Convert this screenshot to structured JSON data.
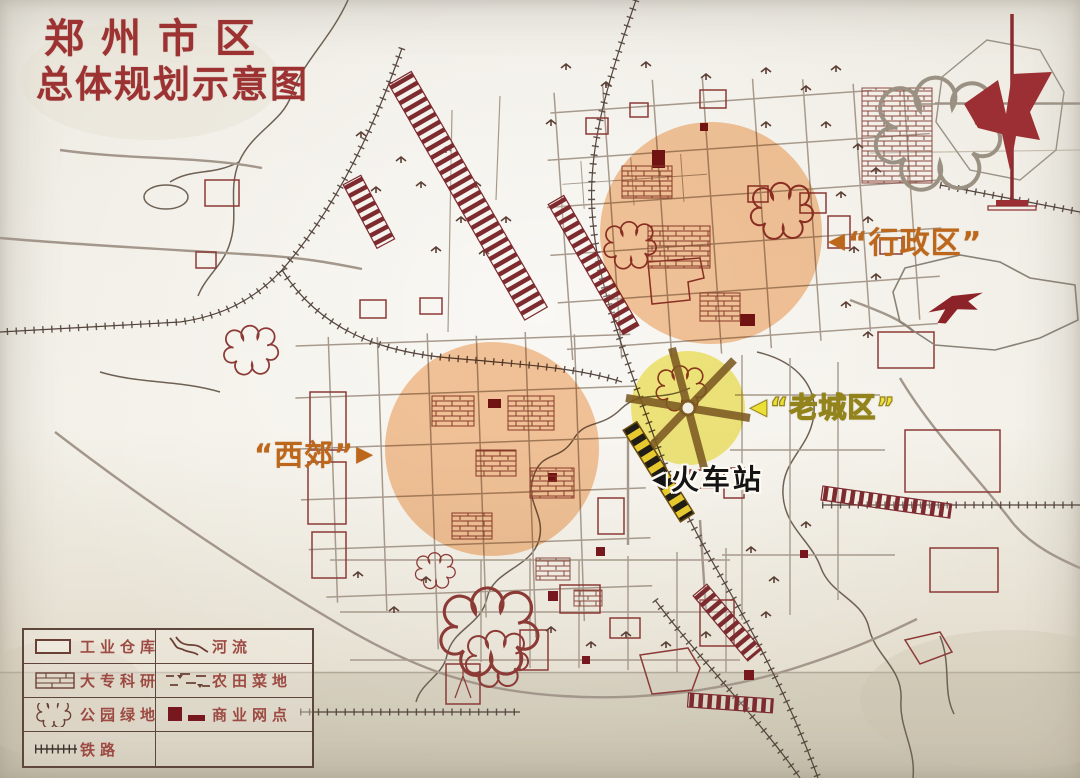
{
  "title": {
    "line1": "郑州市区",
    "line2": "总体规划示意图"
  },
  "annotations": {
    "admin_district": {
      "marker": "◀",
      "text": "“行政区”"
    },
    "old_town": {
      "marker": "◀",
      "text": "“老城区”"
    },
    "west_suburb": {
      "text": "“西郊”",
      "marker": "▶"
    },
    "train_station": {
      "marker": "◀",
      "text": "火车站"
    }
  },
  "zones": {
    "admin_district": {
      "label": "行政区",
      "color": "#f2a45f"
    },
    "west_suburb": {
      "label": "西郊",
      "color": "#f2a45f"
    },
    "old_town": {
      "label": "老城区",
      "color": "#efe34f"
    }
  },
  "legend": {
    "items": [
      {
        "name": "industrial-warehouse",
        "label": "工业仓库"
      },
      {
        "name": "river",
        "label": "河流"
      },
      {
        "name": "college-research",
        "label": "大专科研"
      },
      {
        "name": "farmland-vegetable",
        "label": "农田菜地"
      },
      {
        "name": "park-greenspace",
        "label": "公园绿地"
      },
      {
        "name": "commercial-outlets",
        "label": "商业网点"
      },
      {
        "name": "railway",
        "label": "铁路"
      }
    ]
  },
  "colors": {
    "ink_red": "#8c3434",
    "ink_dark_red": "#76181d",
    "street_gray": "#a3968a",
    "rail_dark": "#53443c",
    "paper": "#f3f0e8",
    "annotation_orange": "#bd671d",
    "annotation_yellow": "#ecdf35",
    "title_red": "#9c3231"
  }
}
